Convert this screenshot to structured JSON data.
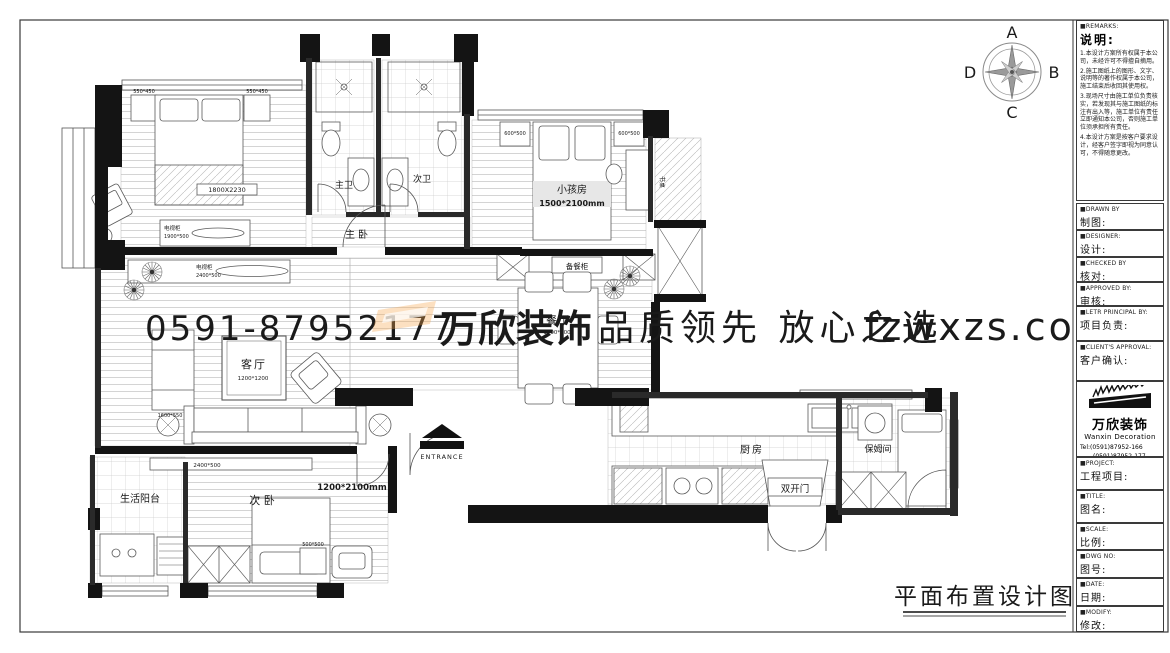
{
  "compass": {
    "n": "A",
    "e": "B",
    "s": "C",
    "w": "D"
  },
  "watermark": {
    "phone": "0591-87952177",
    "logo": "万欣装饰",
    "slogan": "品质领先 放心之选",
    "site": "fzwxzs.com"
  },
  "plan": {
    "title": "平面布置设计图",
    "labels": {
      "master_bedroom": "主卧",
      "master_bath": "主卫",
      "second_bath": "次卫",
      "kids_room": "小孩房",
      "kids_room_size": "1500*2100mm",
      "living_room": "客厅",
      "living_room_size": "1200*1200",
      "dining_room": "餐厅",
      "dining_room_size": "1500*800",
      "second_bedroom": "次 卧",
      "second_bedroom_size": "1200*2100mm",
      "laundry_balcony": "生活阳台",
      "kitchen": "厨房",
      "nanny_room": "保姆间",
      "double_door": "双开门",
      "entrance": "ENTRANCE",
      "serving_cabinet": "备餐柜",
      "desk": "书桌"
    },
    "furniture": {
      "master_bed_size": "1800X2230",
      "nightstand_left_size": "550*450",
      "nightstand_right_size": "550*450",
      "master_tv_cabinet": "电视柜",
      "master_tv_cabinet_size": "1900*500",
      "living_tv_cabinet": "电视柜",
      "living_tv_cabinet_size": "2400*500",
      "side_cabinet_size": "1600*550",
      "kids_cabinet_left_size": "600*500",
      "kids_cabinet_right_size": "600*500",
      "wardrobe_cabinet_size": "2400*500",
      "bedside_table_size": "500*500"
    }
  },
  "titleblock": {
    "remarks": {
      "en": "■REMARKS:",
      "zh": "说明:",
      "notes": [
        "1.本设计方案所有权属于本公司，未经许可不得擅自摘用。",
        "2.施工图纸上的图形、文字、说明等的著作权属于本公司，施工结束后收回其使用权。",
        "3.现场尺寸由施工单位负责核实，若发现其与施工图纸的标注有出入等，施工单位有责任立即通知本公司，否则施工单位须承担所有责任。",
        "4.本设计方案是按客户要求设计，经客户签字即视为同意认可，不得随意更改。"
      ]
    },
    "fields": [
      {
        "en": "■DRAWN BY",
        "zh": "制图:"
      },
      {
        "en": "■DESIGNER:",
        "zh": "设计:"
      },
      {
        "en": "■CHECKED BY",
        "zh": "核对:"
      },
      {
        "en": "■APPROVED BY:",
        "zh": "审核:"
      },
      {
        "en": "■LETR PRINCIPAL BY:",
        "zh": "项目负责:"
      },
      {
        "en": "■CLIENT'S APPROVAL:",
        "zh": "客户确认:"
      }
    ],
    "company": {
      "logo_zh": "万欣装饰",
      "logo_en": "Wanxin Decoration",
      "tel1": "Tel:(0591)87952-166",
      "tel2": "(0591)87952-177",
      "fax": "Fax:(0591)87952-199",
      "web": "Web:WWW.fzwxzs.com"
    },
    "fields2": [
      {
        "en": "■PROJECT:",
        "zh": "工程项目:"
      },
      {
        "en": "■TITLE:",
        "zh": "图名:"
      },
      {
        "en": "■SCALE:",
        "zh": "比例:"
      },
      {
        "en": "■DWG NO:",
        "zh": "图号:"
      },
      {
        "en": "■DATE:",
        "zh": "日期:"
      },
      {
        "en": "■MODIFY:",
        "zh": "修改:"
      }
    ]
  }
}
